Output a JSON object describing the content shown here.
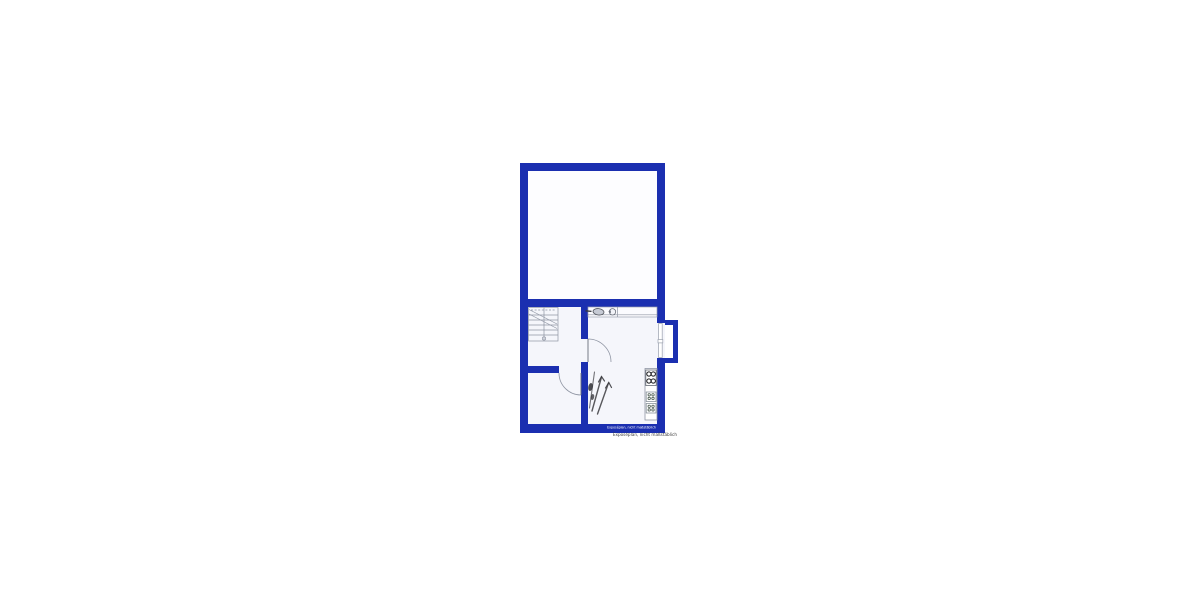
{
  "plan": {
    "kind": "basement-floor-plan",
    "disclaimer_wall": "Exposéplan, nicht maßstäblich",
    "disclaimer_below": "Exposéplan, nicht maßstäblich"
  },
  "colors": {
    "canvas": "#ffffff",
    "wall": "#1b2fb0",
    "upper_room_fill": "#fdfdff",
    "lower_room_fill": "#f5f6fb",
    "line_gray": "#8f95a3",
    "sketch": "#3c3c40"
  }
}
